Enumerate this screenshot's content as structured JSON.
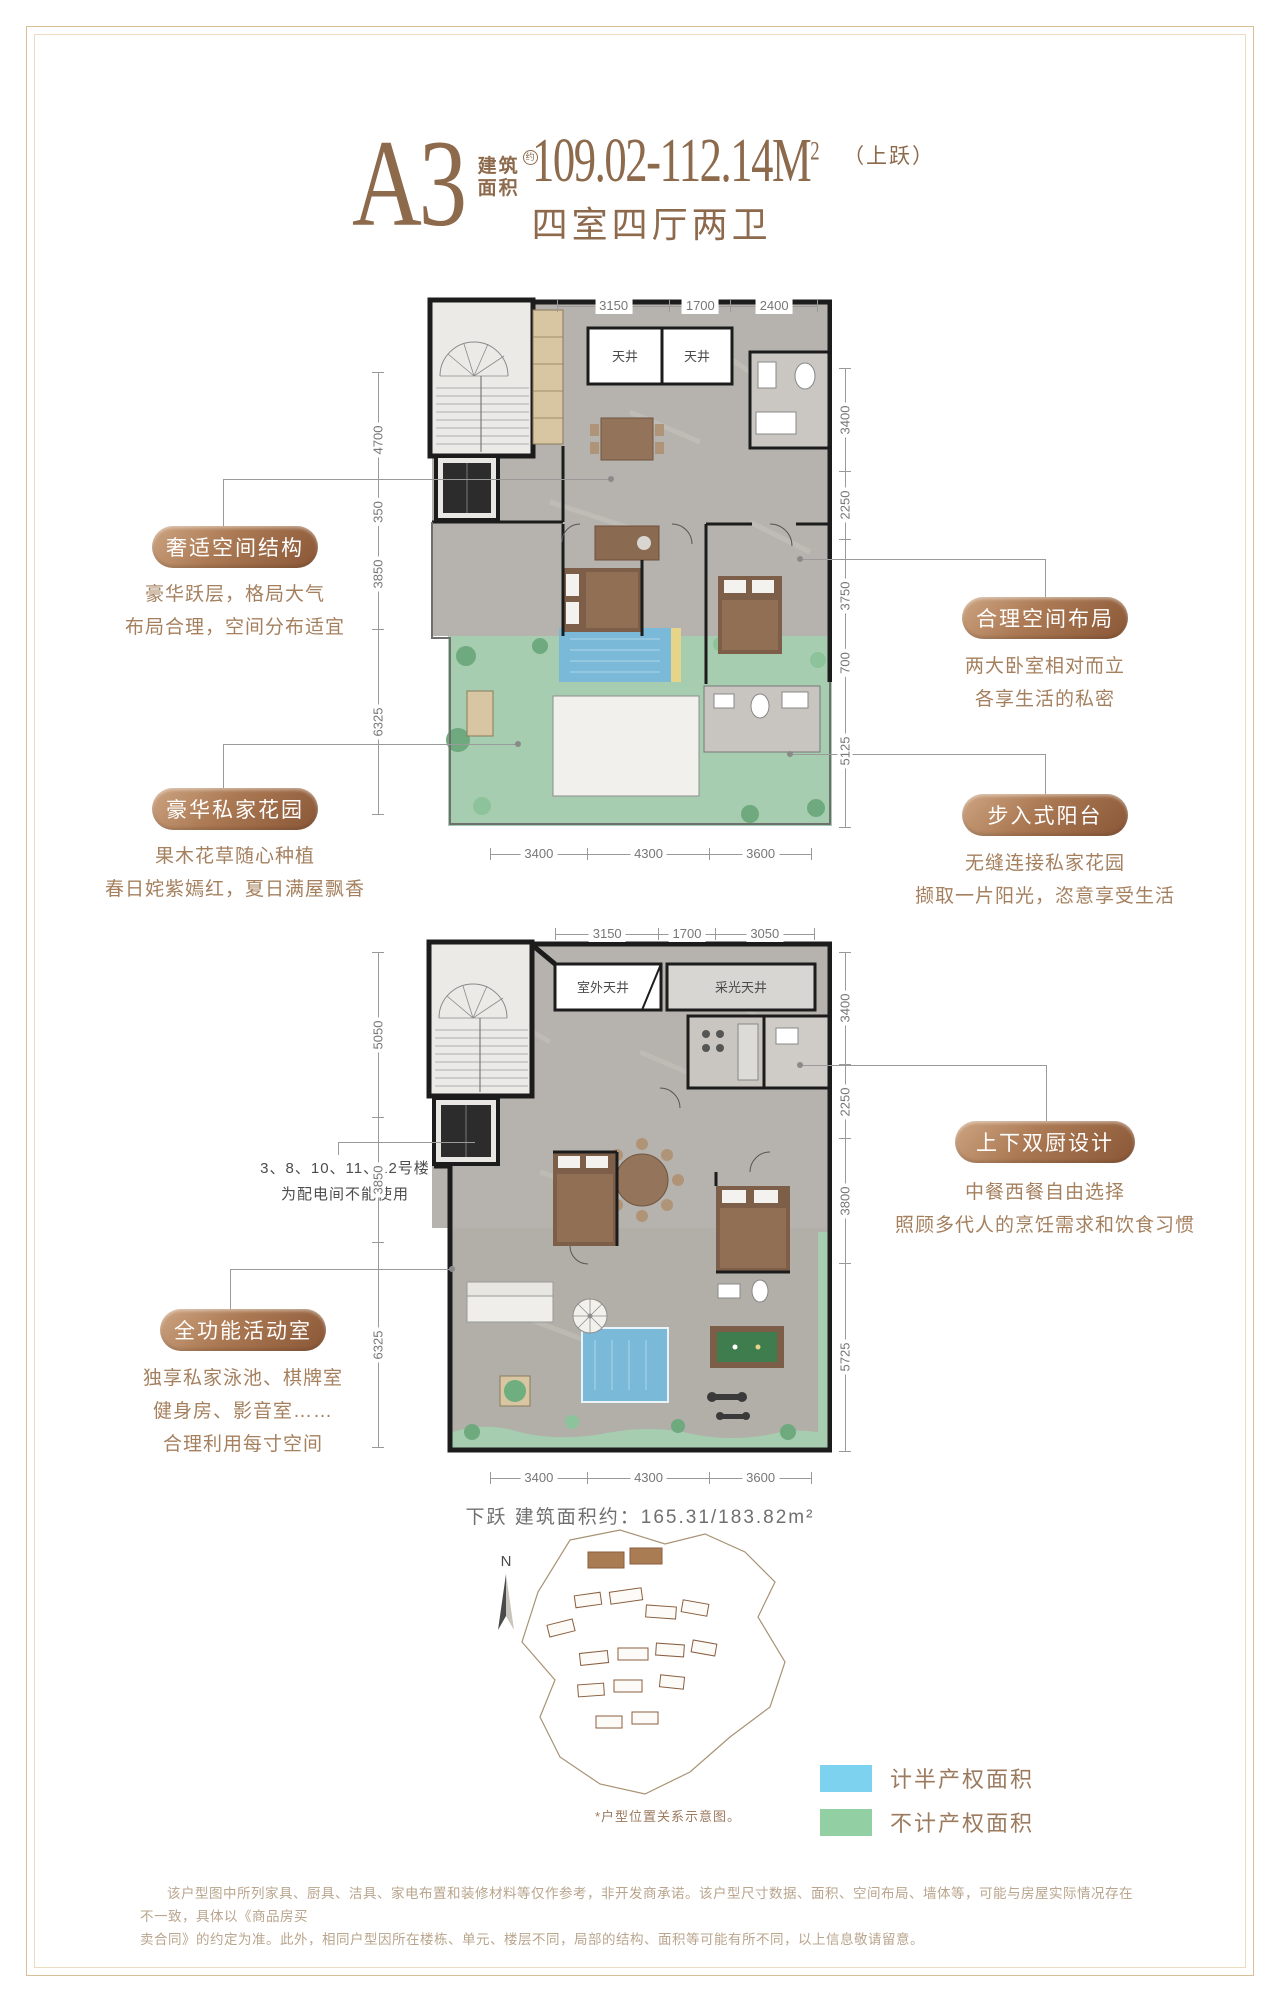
{
  "header": {
    "plan_code": "A3",
    "area_prefix_top": "建筑",
    "area_prefix_bottom": "面积",
    "area_prefix_sup": "约",
    "area_value": "109.02-112.14M",
    "area_value_sup": "2",
    "area_note": "（上跃）",
    "subtitle": "四室四厅两卫"
  },
  "callouts": [
    {
      "label": "奢适空间结构",
      "lines": [
        "豪华跃层，格局大气",
        "布局合理，空间分布适宜"
      ]
    },
    {
      "label": "豪华私家花园",
      "lines": [
        "果木花草随心种植",
        "春日姹紫嫣红，夏日满屋飘香"
      ]
    },
    {
      "label": "合理空间布局",
      "lines": [
        "两大卧室相对而立",
        "各享生活的私密"
      ]
    },
    {
      "label": "步入式阳台",
      "lines": [
        "无缝连接私家花园",
        "撷取一片阳光，恣意享受生活"
      ]
    },
    {
      "label": "上下双厨设计",
      "lines": [
        "中餐西餐自由选择",
        "照顾多代人的烹饪需求和饮食习惯"
      ]
    },
    {
      "label": "全功能活动室",
      "lines": [
        "独享私家泳池、棋牌室",
        "健身房、影音室……",
        "合理利用每寸空间"
      ]
    }
  ],
  "note": {
    "lines": [
      "3、8、10、11、12号楼",
      "为配电间不能使用"
    ]
  },
  "plan_upper": {
    "dims_top": [
      "3150",
      "1700",
      "2400"
    ],
    "dims_left": [
      "4700",
      "350",
      "3850",
      "6325"
    ],
    "dims_right": [
      "3400",
      "2250",
      "3750",
      "700",
      "5125"
    ],
    "dims_bottom": [
      "3400",
      "4300",
      "3600"
    ],
    "rooms": {
      "lightwell_left": "天井",
      "lightwell_right": "天井"
    }
  },
  "plan_lower": {
    "dims_top": [
      "3150",
      "1700",
      "3050"
    ],
    "dims_left": [
      "5050",
      "3850",
      "6325"
    ],
    "dims_right": [
      "3400",
      "2250",
      "3800",
      "5725"
    ],
    "dims_bottom": [
      "3400",
      "4300",
      "3600"
    ],
    "rooms": {
      "lightwell_left": "室外天井",
      "lightwell_right": "采光天井"
    }
  },
  "lower_area_note": "下跃 建筑面积约：165.31/183.82m²",
  "site": {
    "compass_label": "N",
    "caption": "*户型位置关系示意图。",
    "legend": [
      {
        "label": "计半产权面积",
        "color": "#7dd2ef"
      },
      {
        "label": "不计产权面积",
        "color": "#92cfa2"
      }
    ]
  },
  "disclaimer": {
    "lines": [
      "该户型图中所列家具、厨具、洁具、家电布置和装修材料等仅作参考，非开发商承诺。该户型尺寸数据、面积、空间布局、墙体等，可能与房屋实际情况存在不一致，具体以《商品房买",
      "卖合同》的约定为准。此外，相同户型因所在楼栋、单元、楼层不同，局部的结构、面积等可能有所不同，以上信息敬请留意。"
    ]
  },
  "colors": {
    "accent_brown": "#8d6a4c",
    "pill_gradient_dark": "#8a5737",
    "legend_half_right": "#7dd2ef",
    "legend_no_right": "#92cfa2",
    "garden_green": "#a6cdb0",
    "pool_blue": "#7ab9d8"
  }
}
